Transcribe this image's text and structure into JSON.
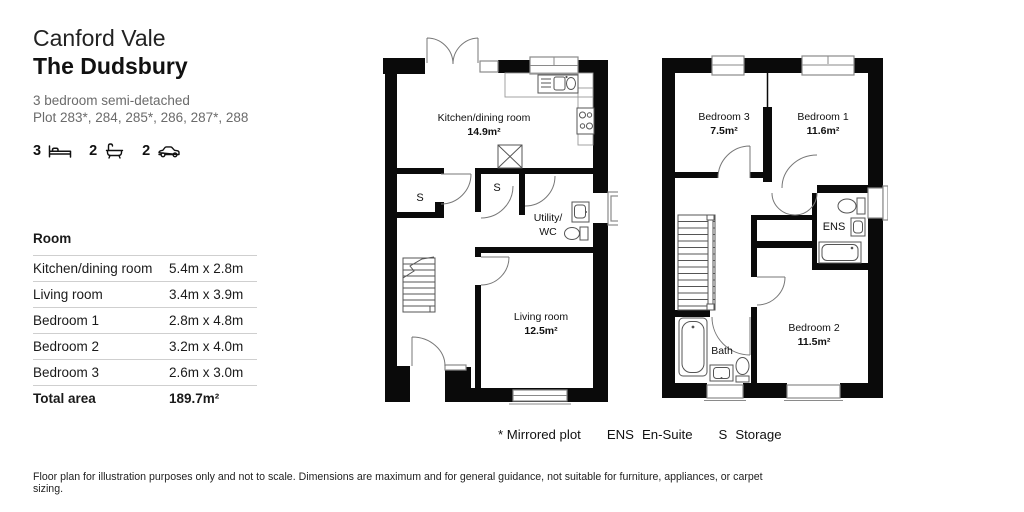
{
  "header": {
    "development": "Canford Vale",
    "home": "The Dudsbury",
    "type": "3 bedroom semi-detached",
    "plots": "Plot 283*, 284, 285*, 286, 287*, 288"
  },
  "specs": {
    "bedrooms": "3",
    "bathrooms": "2",
    "parking": "2"
  },
  "room_table": {
    "header": "Room",
    "rows": [
      {
        "name": "Kitchen/dining room",
        "dims": "5.4m x 2.8m"
      },
      {
        "name": "Living room",
        "dims": "3.4m x 3.9m"
      },
      {
        "name": "Bedroom 1",
        "dims": "2.8m x 4.8m"
      },
      {
        "name": "Bedroom 2",
        "dims": "3.2m x 4.0m"
      },
      {
        "name": "Bedroom 3",
        "dims": "2.6m x 3.0m"
      }
    ],
    "total_label": "Total area",
    "total_value": "189.7m²"
  },
  "ground_floor": {
    "kitchen": {
      "label": "Kitchen/dining room",
      "area": "14.9m²"
    },
    "living": {
      "label": "Living room",
      "area": "12.5m²"
    },
    "utility": {
      "line1": "Utility/",
      "line2": "WC"
    },
    "storage1": "S",
    "storage2": "S"
  },
  "first_floor": {
    "bedroom3": {
      "label": "Bedroom 3",
      "area": "7.5m²"
    },
    "bedroom1": {
      "label": "Bedroom 1",
      "area": "11.6m²"
    },
    "bedroom2": {
      "label": "Bedroom 2",
      "area": "11.5m²"
    },
    "ensuite": "ENS",
    "bath": "Bath"
  },
  "legend": {
    "mirrored": "* Mirrored plot",
    "ens_abbr": "ENS",
    "ens_label": "En-Suite",
    "storage_abbr": "S",
    "storage_label": "Storage"
  },
  "footer": "Floor plan for illustration purposes only and not to scale. Dimensions are maximum and for general guidance, not suitable for furniture, appliances, or carpet sizing.",
  "colors": {
    "wall": "#0a0a0a",
    "text": "#1a1a1a",
    "muted": "#6b6b6b",
    "divider": "#cfcfcf",
    "fixture_line": "#555555"
  }
}
